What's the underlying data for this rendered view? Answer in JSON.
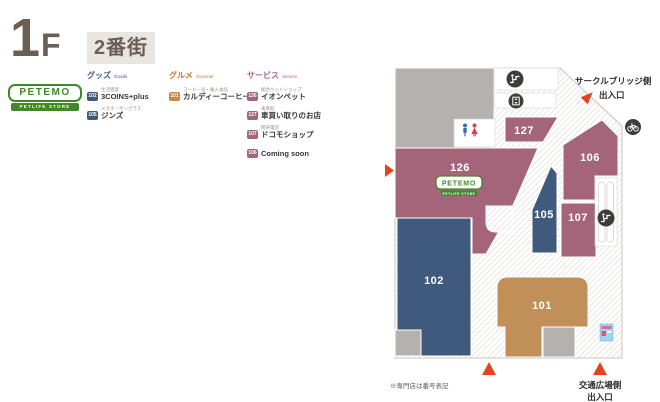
{
  "header": {
    "floor_number": "1",
    "floor_letter": "F",
    "street_name": "2番街"
  },
  "logo": {
    "brand": "PETEMO",
    "tagline": "PETLIFE STORE"
  },
  "legend": {
    "goods": {
      "title": "グッズ",
      "subtitle": "Goods",
      "items": [
        {
          "num": "102",
          "category": "生活雑貨",
          "name": "3COINS+plus"
        },
        {
          "num": "105",
          "category": "メガネ・サングラス",
          "name": "ジンズ"
        }
      ]
    },
    "gourmet": {
      "title": "グルメ",
      "subtitle": "Gourmet",
      "items": [
        {
          "num": "101",
          "category": "コーヒー豆・輸入食品",
          "name": "カルディーコーヒー"
        }
      ]
    },
    "service": {
      "title": "サービス",
      "subtitle": "Service",
      "items": [
        {
          "num": "126",
          "category": "総合ペットショップ",
          "name": "イオンペット"
        },
        {
          "num": "127",
          "category": "車買取",
          "name": "車買い取りのお店"
        },
        {
          "num": "107",
          "category": "携帯電話",
          "name": "ドコモショップ"
        },
        {
          "num": "106",
          "category": "",
          "name": "Coming soon"
        }
      ]
    }
  },
  "map": {
    "areas": {
      "a127": "127",
      "a126": "126",
      "a106": "106",
      "a105": "105",
      "a107": "107",
      "a102": "102",
      "a101": "101"
    },
    "map_logo": {
      "brand": "PETEMO",
      "tagline": "PETLIFE STORE"
    },
    "exit_top": {
      "line1": "サークルブリッジ側",
      "line2": "出入口"
    },
    "exit_bottom": {
      "line1": "交通広場側",
      "line2": "出入口"
    },
    "note": "※専門店は番号表記"
  },
  "icons": {
    "escalator": "escalator-icon",
    "elevator": "elevator-icon",
    "restroom": "restroom-icon",
    "bicycle_parking": "bicycle-parking-icon",
    "photo_kiosk": "photo-kiosk-icon"
  },
  "colors": {
    "goods": "#3f5a7d",
    "gourmet_area": "#c18f58",
    "service": "#a4657b",
    "gourmet_badge": "#c4883f",
    "gray_block": "#b5b1ae",
    "red_arrow": "#e8421c",
    "accent_green": "#3e8a27",
    "heading": "#6b5e54",
    "icon_circle": "#3d3d3b"
  }
}
